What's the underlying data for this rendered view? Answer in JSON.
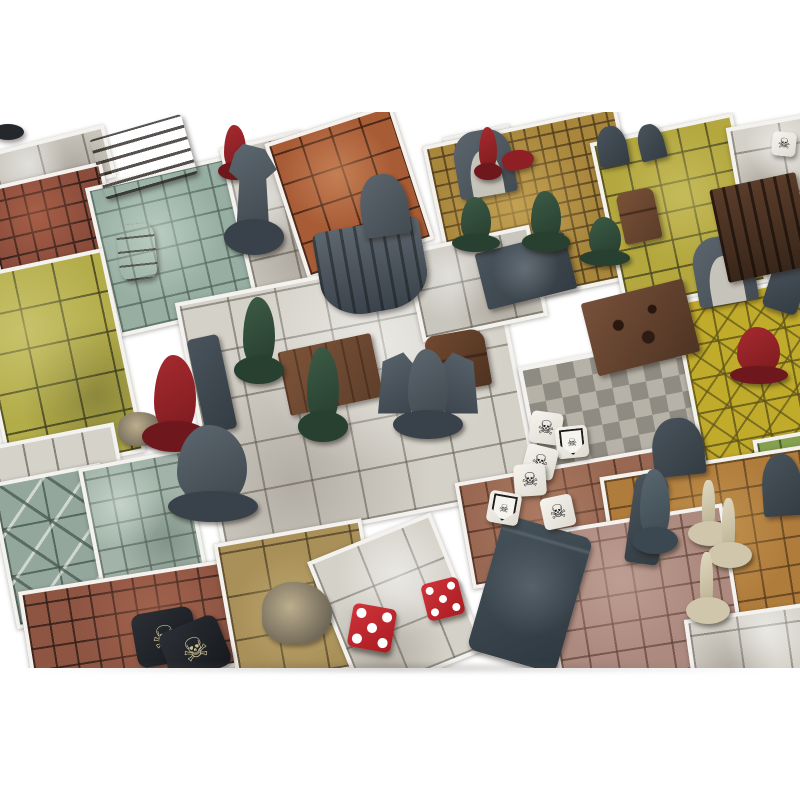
{
  "scene": {
    "description": "Overhead product photo of a fantasy dungeon-crawler board game on a white background: modular tiled dungeon rooms separated by white grout, plastic miniatures, furniture pieces, combat dice and skull tokens.",
    "rooms": [
      {
        "name": "white-corridor-top-left",
        "color": "#c9c6bd"
      },
      {
        "name": "red-brick-room",
        "color": "#8a4c3c"
      },
      {
        "name": "teal-tile-room",
        "color": "#97aea3"
      },
      {
        "name": "mossy-yellow-green-room",
        "color": "#b2ac49"
      },
      {
        "name": "orange-cracked-corridor",
        "color": "#a85c36"
      },
      {
        "name": "gold-small-tile-room",
        "color": "#a8873d"
      },
      {
        "name": "yellow-cracked-room",
        "color": "#b3a73e"
      },
      {
        "name": "white-marble-room-top-right",
        "color": "#d4d1c8"
      },
      {
        "name": "central-white-stone-room",
        "color": "#d4d1c8"
      },
      {
        "name": "checkerboard-room",
        "color": "#b6b2a8"
      },
      {
        "name": "yellow-diamond-room",
        "color": "#c1ab2b"
      },
      {
        "name": "rust-mottled-room",
        "color": "#996852"
      },
      {
        "name": "orange-room-bottom-right",
        "color": "#b07c3c"
      },
      {
        "name": "pink-mauve-room",
        "color": "#ad8a7f"
      },
      {
        "name": "triangle-pinwheel-room",
        "color": "#93a79c"
      },
      {
        "name": "teal-cobblestone-room",
        "color": "#a2b4a9"
      },
      {
        "name": "rust-brick-room-bottom-left",
        "color": "#8f5543"
      },
      {
        "name": "tan-slab-room-with-rubble",
        "color": "#a99058"
      },
      {
        "name": "white-plank-corridor",
        "color": "#d5d2c9"
      },
      {
        "name": "green-tile-edge",
        "color": "#85a04f"
      }
    ],
    "furniture": [
      "bookshelf",
      "barrel",
      "altar-throne",
      "tombstones",
      "stone-arches",
      "treasure-chest",
      "cabinet",
      "alchemist-workbench",
      "stone-tomb",
      "sarcophagus",
      "wooden-table",
      "wooden-chair",
      "wall-ledge",
      "rubble-pile"
    ],
    "miniatures": {
      "green_goblins": 5,
      "red_heroes": 4,
      "gray_monsters": 3,
      "bone_skeletons": 3,
      "teal_figure": 1
    },
    "dice": {
      "white_combat_dice": {
        "count": 7,
        "faces_shown": [
          "skull",
          "shield",
          "skull",
          "skull",
          "shield",
          "skull",
          "skull"
        ]
      },
      "red_pip_dice": {
        "count": 2,
        "values": [
          5,
          5
        ]
      }
    },
    "tokens": {
      "skull_tokens": 2
    }
  },
  "icons": {
    "skull": "☠"
  },
  "colors": {
    "background": "#ffffff",
    "grout": "#f3f2ee",
    "mini_green": "#2f4e3b",
    "mini_red": "#962026",
    "mini_gray": "#4e565e",
    "mini_bone": "#d8d0b6",
    "wood": "#6b4732",
    "die_white": "#f6f4ee",
    "die_red": "#c5262c",
    "token_black": "#22262c"
  }
}
